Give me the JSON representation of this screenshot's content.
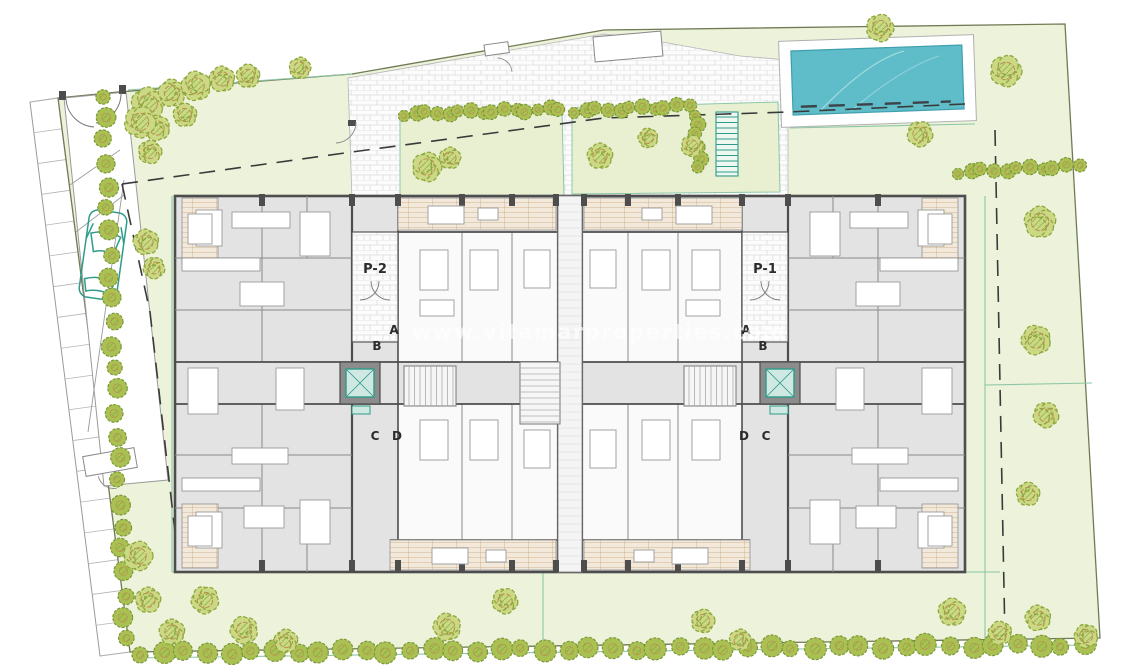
{
  "title": "Residential complex ground floor site plan",
  "watermark": {
    "text": "www.vitamarproperties.com"
  },
  "labels": {
    "portal_left": "P-2",
    "portal_right": "P-1",
    "stair_left_a": "A",
    "stair_left_b": "B",
    "stair_left_c": "C",
    "stair_left_d": "D",
    "stair_right_a": "A",
    "stair_right_b": "B",
    "stair_right_c": "C",
    "stair_right_d": "D"
  },
  "colors": {
    "site_green": "#edf2da",
    "strip_green": "#e9f0d2",
    "tree_fill": "#cbd884",
    "tree_stroke": "#8fa73e",
    "tree_accent": "#bb8f4e",
    "hedge_fill": "#a9c053",
    "hedge_stroke": "#7d9738",
    "pool_water": "#5fbdc9",
    "pool_edge": "#3f9fae",
    "wall_dark": "#4d4d4d",
    "partition_gray": "#8a8a8a",
    "building_fill": "#e3e3e3",
    "room_white": "#fafafa",
    "deck_fill": "#f3e9da",
    "deck_line": "#dbc6ac",
    "deck_red": "#c89a72",
    "teal_line": "#8cc7a6",
    "car_teal": "#2e9c8a",
    "elevator_teal": "#cfe8e2",
    "dashed_line": "#3a3a3a",
    "watermark_color": "rgba(255,255,255,0.62)"
  }
}
